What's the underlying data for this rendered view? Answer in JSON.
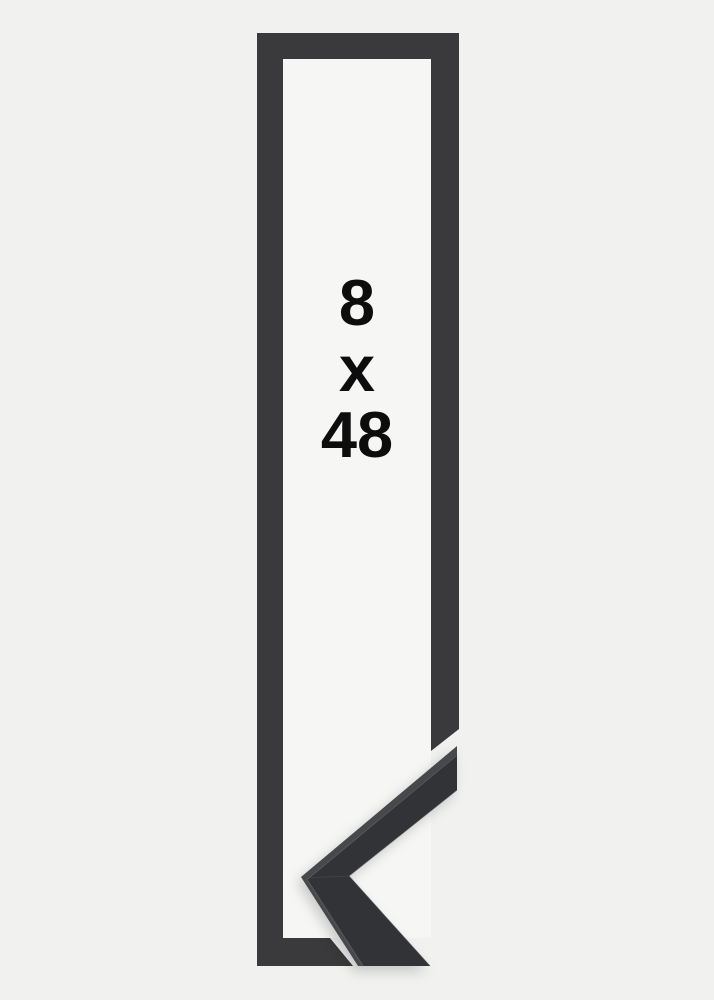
{
  "product_image": {
    "description_of_graphic": "tall narrow picture frame outline with mitered corner sample at bottom right",
    "size_text": {
      "width_value": "8",
      "separator": "x",
      "height_value": "48"
    },
    "colors": {
      "background": "#f1f1f0",
      "inner_background": "#f6f6f5",
      "frame_outline": "#3a3a3c",
      "sample_top_edge": "#47484c",
      "sample_face": "#323336",
      "text": "#0d0d0d"
    }
  }
}
